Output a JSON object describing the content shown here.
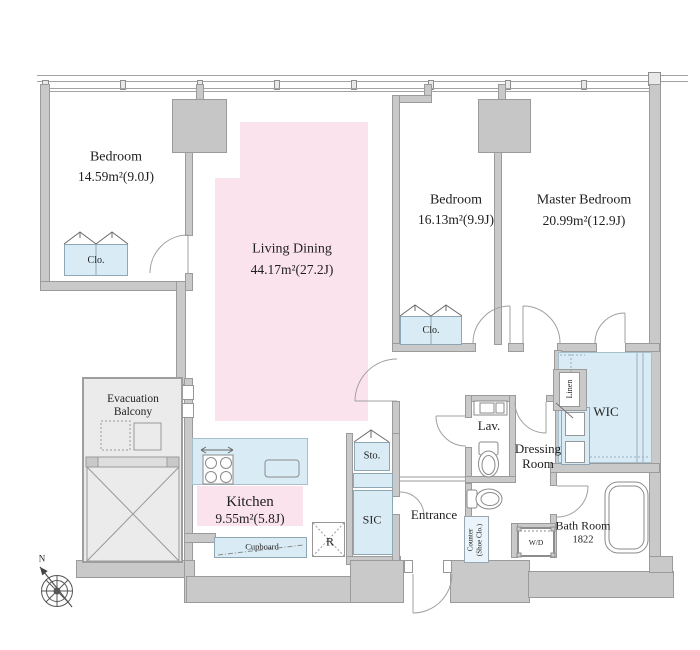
{
  "compass_label": "N",
  "rooms": {
    "bedroom1": {
      "name": "Bedroom",
      "area": "14.59m²(9.0J)"
    },
    "living_dining": {
      "name": "Living Dining",
      "area": "44.17m²(27.2J)"
    },
    "bedroom2": {
      "name": "Bedroom",
      "area": "16.13m²(9.9J)"
    },
    "master_bedroom": {
      "name": "Master Bedroom",
      "area": "20.99m²(12.9J)"
    },
    "kitchen": {
      "name": "Kitchen",
      "area": "9.55m²(5.8J)"
    },
    "evacuation_balcony": {
      "line1": "Evacuation",
      "line2": "Balcony"
    },
    "entrance": {
      "name": "Entrance"
    },
    "lavatory": {
      "name": "Lav."
    },
    "dressing_room": {
      "line1": "Dressing",
      "line2": "Room"
    },
    "wic": {
      "name": "WIC"
    },
    "bath_room": {
      "name": "Bath Room",
      "size": "1822"
    }
  },
  "fixtures": {
    "closet1": "Clo.",
    "closet2": "Clo.",
    "storage": "Sto.",
    "sic": "SIC",
    "linen": "Linen",
    "washer_dryer": "W/D",
    "shoe_counter_line1": "Counter",
    "shoe_counter_line2": "(Shoe Clo.)",
    "cupboard": "Cupboard",
    "refrigerator": "R"
  },
  "colors": {
    "room_pink": "#fae3ec",
    "fixture_blue": "#d9ecf6",
    "wall_gray": "#c9c9c9",
    "balcony_gray": "#ebebeb"
  }
}
